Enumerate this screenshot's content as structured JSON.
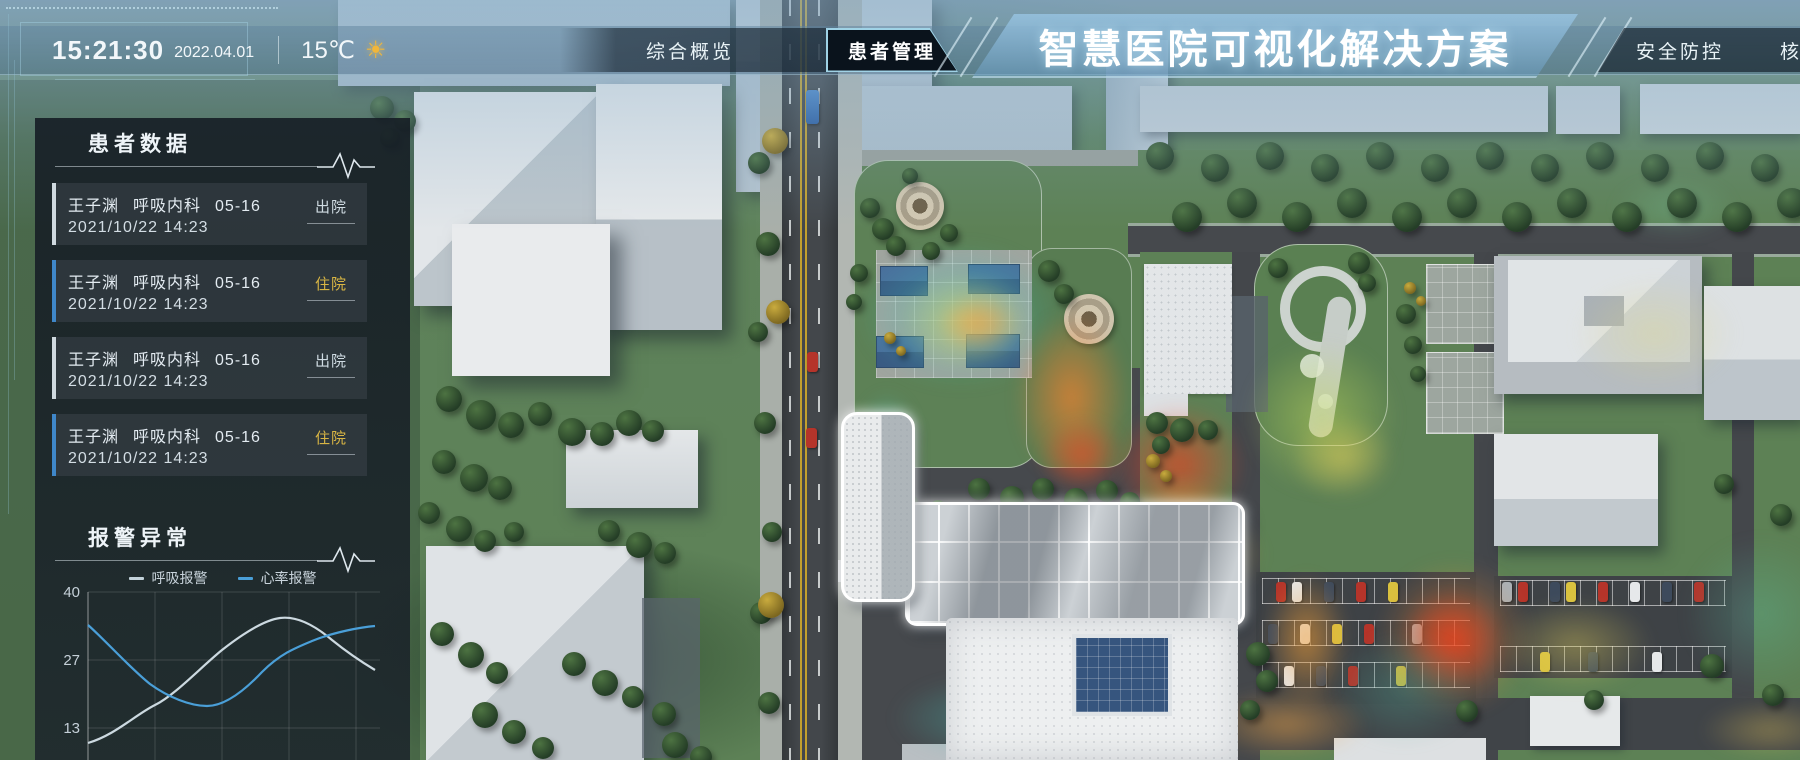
{
  "header": {
    "time": "15:21:30",
    "date": "2022.04.01",
    "temperature": "15℃",
    "weather_icon": "sun-icon",
    "title": "智慧医院可视化解决方案",
    "nav_left": [
      {
        "label": "综合概览",
        "active": false
      },
      {
        "label": "患者管理",
        "active": true
      }
    ],
    "nav_right": [
      {
        "label": "安全防控",
        "active": false
      },
      {
        "label": "核",
        "active": false,
        "truncated": true
      }
    ]
  },
  "sidebar": {
    "patients": {
      "title": "患者数据",
      "items": [
        {
          "name": "王子渊",
          "department": "呼吸内科",
          "bed": "05-16",
          "datetime": "2021/10/22 14:23",
          "status": "出院"
        },
        {
          "name": "王子渊",
          "department": "呼吸内科",
          "bed": "05-16",
          "datetime": "2021/10/22 14:23",
          "status": "住院"
        },
        {
          "name": "王子渊",
          "department": "呼吸内科",
          "bed": "05-16",
          "datetime": "2021/10/22 14:23",
          "status": "出院"
        },
        {
          "name": "王子渊",
          "department": "呼吸内科",
          "bed": "05-16",
          "datetime": "2021/10/22 14:23",
          "status": "住院"
        }
      ],
      "status_colors": {
        "出院": "#cfdbe2",
        "住院": "#d8b544"
      }
    },
    "alarms": {
      "title": "报警异常"
    }
  },
  "chart_data": {
    "type": "line",
    "title": "报警异常",
    "x": [
      0,
      1,
      2,
      3,
      4
    ],
    "xticks_visible": false,
    "series": [
      {
        "name": "呼吸报警",
        "color": "#c3d2da",
        "values": [
          10,
          18,
          29,
          35,
          27
        ]
      },
      {
        "name": "心率报警",
        "color": "#4a9fd8",
        "values": [
          33,
          21,
          18,
          29,
          32
        ]
      }
    ],
    "yticks": [
      13,
      27,
      40
    ],
    "ylim": [
      0,
      40
    ],
    "grid": true,
    "smooth": true,
    "legend_position": "top"
  }
}
